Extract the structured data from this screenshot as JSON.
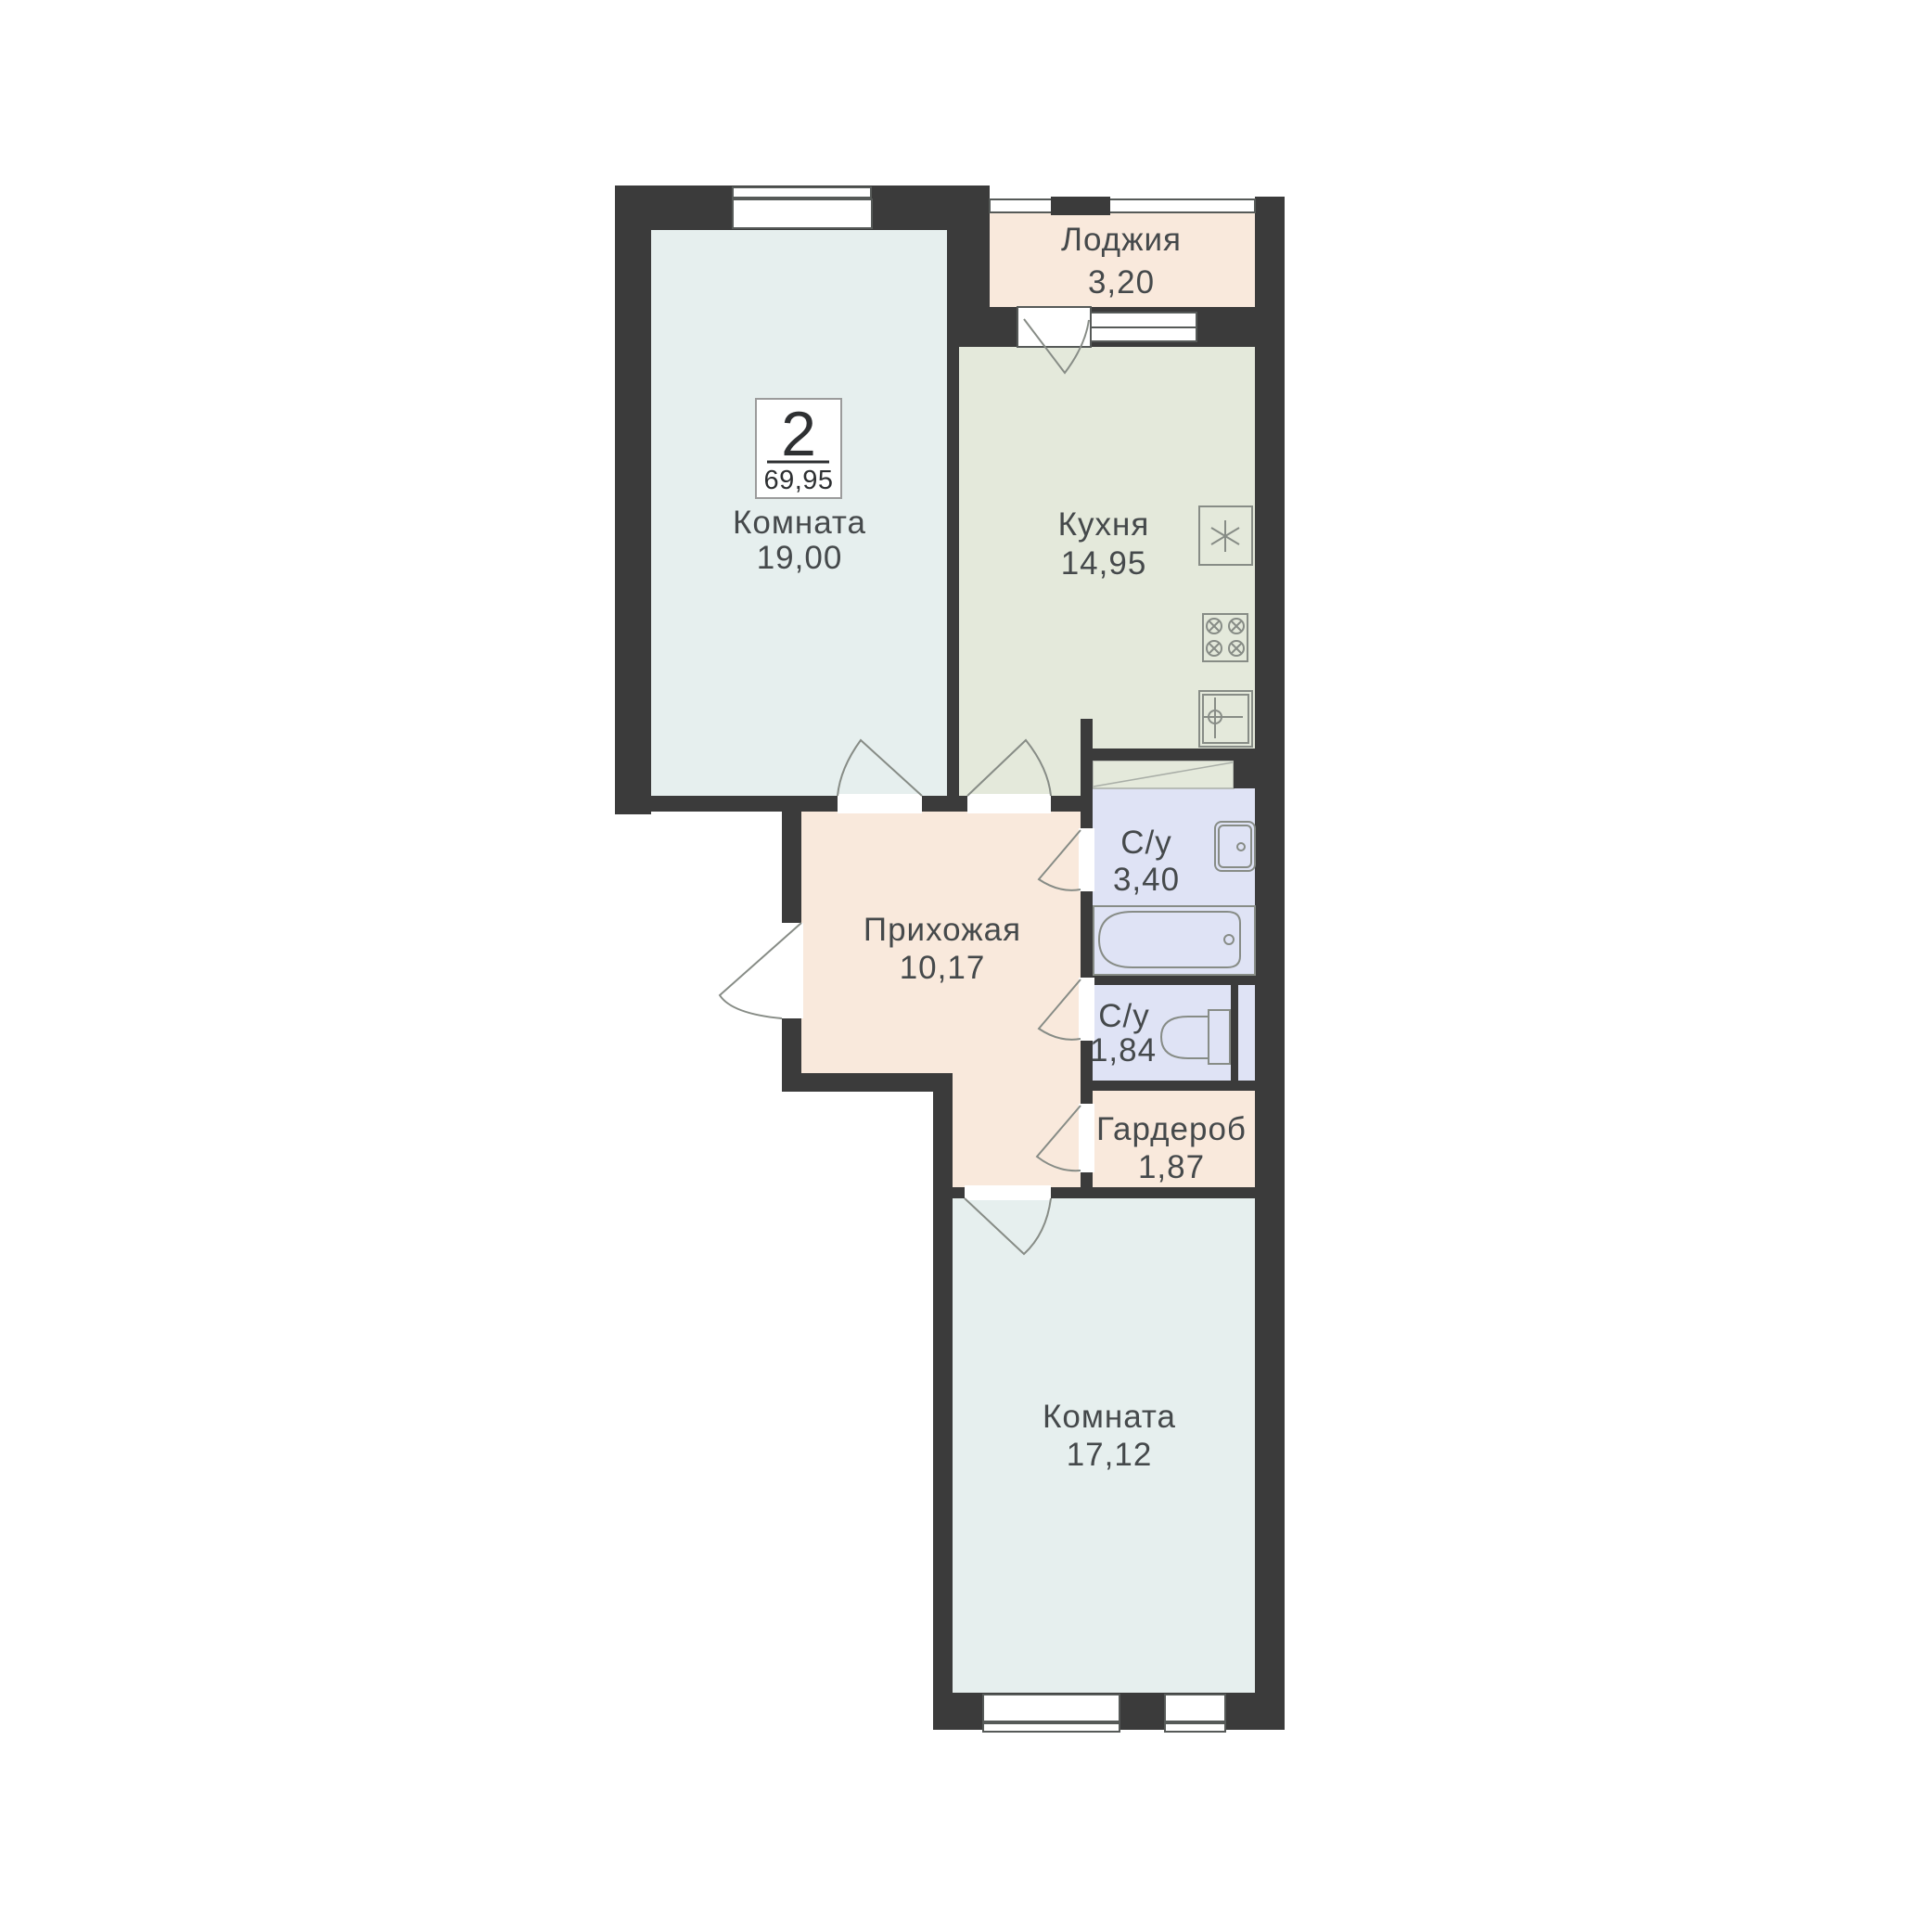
{
  "badge": {
    "rooms_count": "2",
    "total_area": "69,95"
  },
  "rooms": {
    "loggia": {
      "label": "Лоджия",
      "area": "3,20"
    },
    "living1": {
      "label": "Комната",
      "area": "19,00"
    },
    "kitchen": {
      "label": "Кухня",
      "area": "14,95"
    },
    "hallway": {
      "label": "Прихожая",
      "area": "10,17"
    },
    "bathroom": {
      "label": "С/у",
      "area": "3,40"
    },
    "toilet": {
      "label": "С/у",
      "area": "1,84"
    },
    "wardrobe": {
      "label": "Гардероб",
      "area": "1,87"
    },
    "living2": {
      "label": "Комната",
      "area": "17,12"
    }
  },
  "colors": {
    "background": "#ffffff",
    "wall": "#3b3b3b",
    "living": "#e6efee",
    "kitchen": "#e4e9db",
    "loggia": "#f9e9dc",
    "hallway": "#f9e9dc",
    "wardrobe": "#f9e9dc",
    "bathroom": "#dfe3f5",
    "opening": "#ffffff",
    "line": "#878c86",
    "window_frame": "#565a58",
    "text": "#45494b",
    "badge_text": "#2e3032",
    "badge_border": "#9b9b9b"
  }
}
